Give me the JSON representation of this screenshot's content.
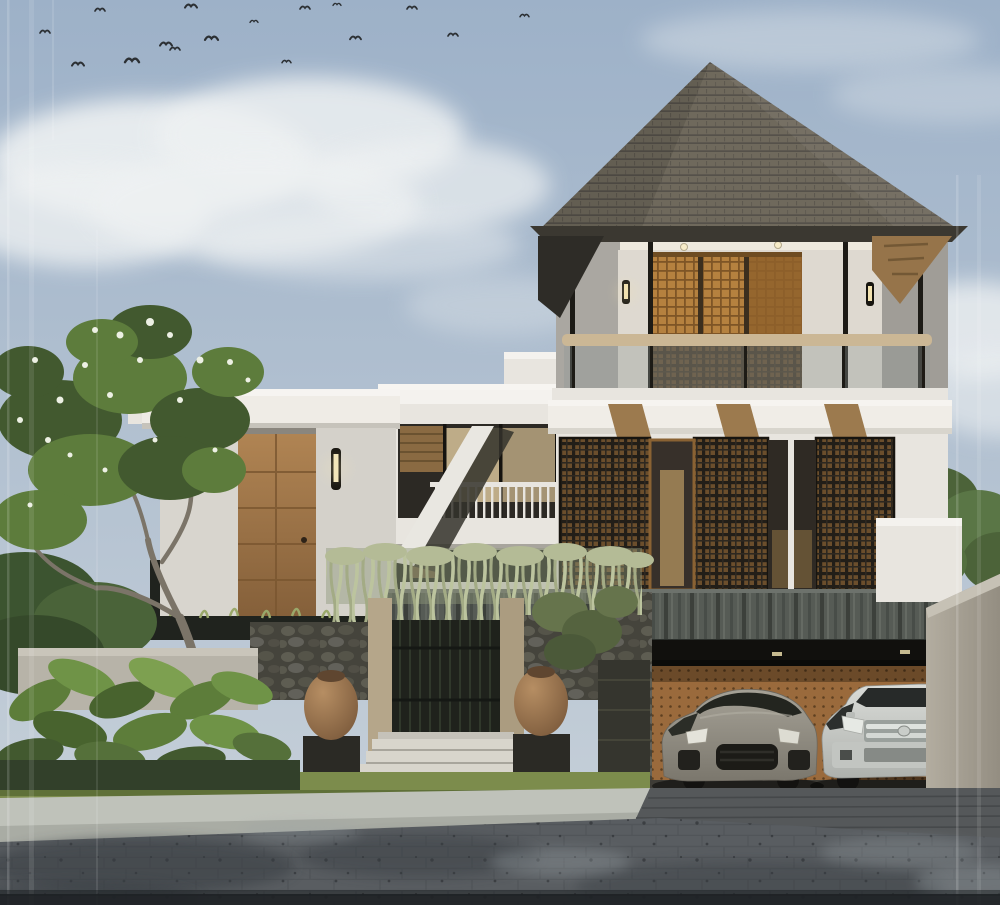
{
  "meta": {
    "kind": "architectural-exterior-render",
    "width": 1000,
    "height": 905
  },
  "scene": {
    "setting": "Modern tropical two-storey villa, front elevation, daytime render",
    "sky": {
      "label": "hazy blue sky with clouds",
      "birds_count": 16
    },
    "house": {
      "roof": "large pyramidal dark shingle roof",
      "upper_balcony": {
        "doors": "wooden lattice sliding doors",
        "downlights": 2,
        "wall_lamps": 2,
        "railing": "glass balustrade with wooden handrail",
        "columns": "slim black steel columns"
      },
      "middle_floor": {
        "screens": "three dark metal lattice screens over warm wood",
        "corbels": 3,
        "glass_doors": 2,
        "fascia": "white stepped fascia band"
      },
      "stone_band": "dark stone-clad parapet band",
      "garage": {
        "wall": "perforated timber garage back wall",
        "soffit_lights": 2,
        "cars": [
          {
            "label": "gray sports SUV"
          },
          {
            "label": "silver SUV with chrome grille"
          }
        ]
      },
      "left_wing": {
        "entry_door": "tall wooden entrance door",
        "sconces": 2,
        "balcony": "white balcony with slim balusters",
        "windows": "warm-lit glass facade with timber slats",
        "awning": "sloped white awning"
      }
    },
    "landscape": {
      "frangipani_tree": "frangipani tree with white flowers",
      "right_tree": "green tree behind side wall",
      "hanging_vines": "pale green vines draped over gate wall",
      "stone_fence": "natural lava-stone fence",
      "gate": "dark lattice pedestrian gate with timber posts",
      "urns": 2,
      "steps": 4,
      "tropical_plants": "tropical foliage bed with banana leaves",
      "grass": "grass verge",
      "curb": "light concrete curb",
      "driveway": "paver driveway ramp to garage",
      "road": "dark paver road with tree shadows",
      "side_wall": "sloped concrete side wall"
    }
  },
  "theme": {
    "sky-top": "#9db1c8",
    "sky-bottom": "#c9d2da",
    "cloud": "#eef1f2",
    "roof": "#6f695c",
    "roof-line": "#55514a",
    "roof-rim": "#3b3831",
    "eave-wood": "#96744a",
    "wall-white": "#e8e5df",
    "wall-bright": "#f4f2ee",
    "wall-shadow": "#c7c4bd",
    "wall-gray": "#aaa7a1",
    "wood-door": "#a37a48",
    "wood-dark": "#7a5630",
    "lattice-wood": "#b5813f",
    "lattice-dark": "#221e18",
    "glass-dark": "#2c2924",
    "glass-warm": "#d8c39a",
    "handrail": "#cbb795",
    "stone-band": "#565b55",
    "rock": "#45443c",
    "garage-wall": "#9a6a3c",
    "garage-dark": "#15130f",
    "car-gray": "#98948a",
    "car-silver": "#cfd1cd",
    "vine": "#b7bf9b",
    "leaf": "#5d7c3c",
    "leaf-dark": "#42592f",
    "grass": "#7c8c4c",
    "urn": "#a57e57",
    "step": "#d8d5cc",
    "curb": "#bfc2ba",
    "road": "#595d61",
    "road-shadow": "#383e42",
    "road-light": "#9aa2a6",
    "trunk": "#7b7468",
    "concrete": "#a8a296"
  }
}
